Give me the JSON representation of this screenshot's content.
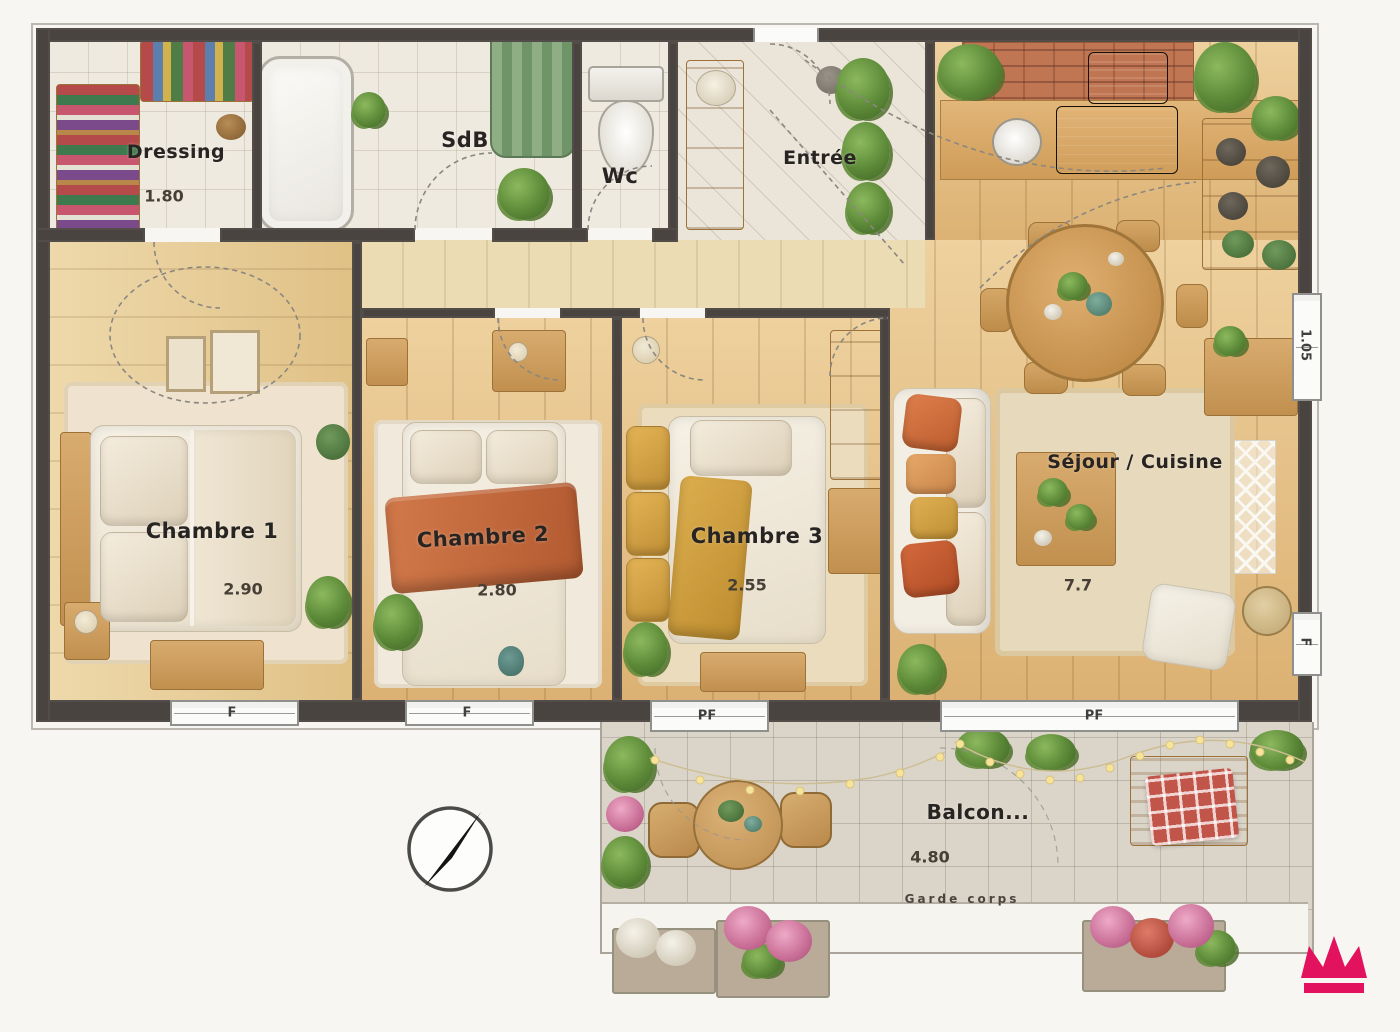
{
  "plan": {
    "type": "apartment-floor-plan",
    "style": "watercolor-render"
  },
  "rooms": {
    "dressing": {
      "label": "Dressing",
      "dim": "1.80"
    },
    "sdb": {
      "label": "SdB"
    },
    "wc": {
      "label": "Wc"
    },
    "entree": {
      "label": "Entrée"
    },
    "chambre1": {
      "label": "Chambre 1",
      "dim": "2.90"
    },
    "chambre2": {
      "label": "Chambre 2",
      "dim": "2.80"
    },
    "chambre3": {
      "label": "Chambre 3",
      "dim": "2.55"
    },
    "sejour": {
      "label": "Séjour / Cuisine",
      "dim": "7.7"
    },
    "balcon": {
      "label": "Balcon...",
      "dim": "4.80",
      "note": "Garde corps"
    }
  },
  "openings": {
    "window_f1": "F",
    "window_f2": "F",
    "window_pf1": "PF",
    "window_pf2": "PF",
    "side_window_dim": "1.05",
    "side_window_tag": "F"
  },
  "icons": {
    "compass": "compass-rose-needle-NE",
    "logo": "pink-crown"
  },
  "colors": {
    "wall": "#49443f",
    "wood_floor": "#e8c98f",
    "blanket_orange": "#c9693e",
    "throw_yellow": "#d5a344",
    "logo_pink": "#e3125e"
  }
}
